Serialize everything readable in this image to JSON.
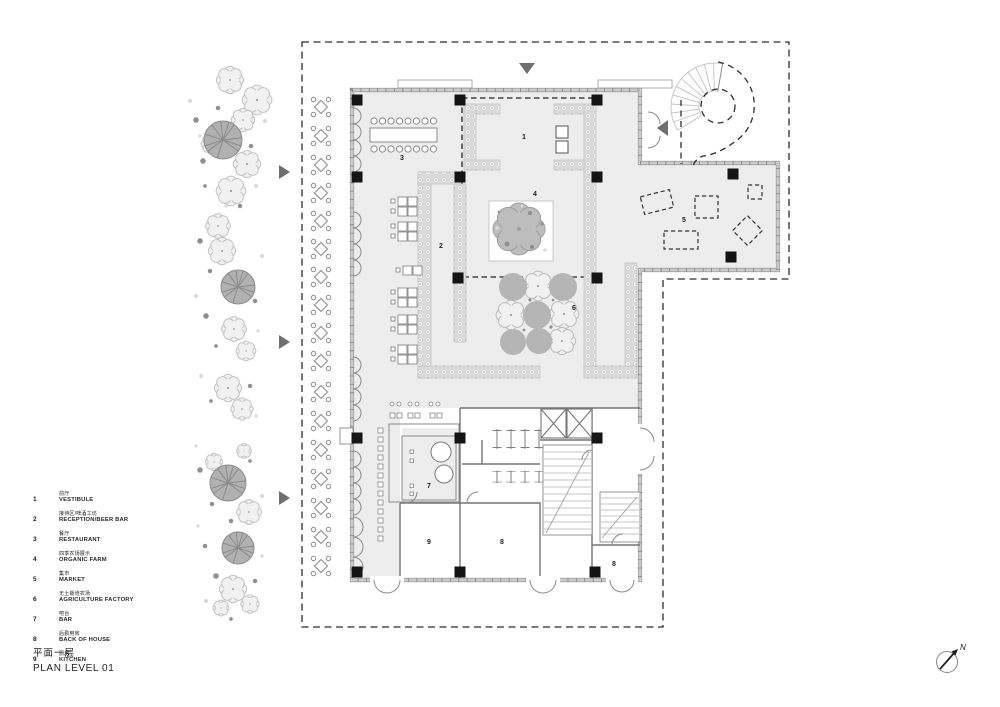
{
  "legend": {
    "items": [
      {
        "num": "1",
        "zh": "前厅",
        "en": "VESTIBULE"
      },
      {
        "num": "2",
        "zh": "接待区/啤酒工坊",
        "en": "RECEPTION/BEER BAR"
      },
      {
        "num": "3",
        "zh": "餐厅",
        "en": "RESTAURANT"
      },
      {
        "num": "4",
        "zh": "四季农场展示",
        "en": "ORGANIC FARM"
      },
      {
        "num": "5",
        "zh": "集市",
        "en": "MARKET"
      },
      {
        "num": "6",
        "zh": "无土栽培农场",
        "en": "AGRICULTURE FACTORY"
      },
      {
        "num": "7",
        "zh": "吧台",
        "en": "BAR"
      },
      {
        "num": "8",
        "zh": "后勤用房",
        "en": "BACK OF HOUSE"
      },
      {
        "num": "9",
        "zh": "厨房",
        "en": "KITCHEN"
      }
    ]
  },
  "title_block": {
    "zh": "平面一层",
    "en": "PLAN LEVEL 01"
  },
  "plan": {
    "room_labels": [
      "1",
      "2",
      "3",
      "4",
      "5",
      "6",
      "7",
      "8",
      "8",
      "9"
    ]
  },
  "north": {
    "label": "N"
  },
  "colors": {
    "floor": "#ededed",
    "tree_gray": "#a9a9a9",
    "wall": "#8c8c8c",
    "dash": "#2e2e2e",
    "column": "#141414"
  }
}
